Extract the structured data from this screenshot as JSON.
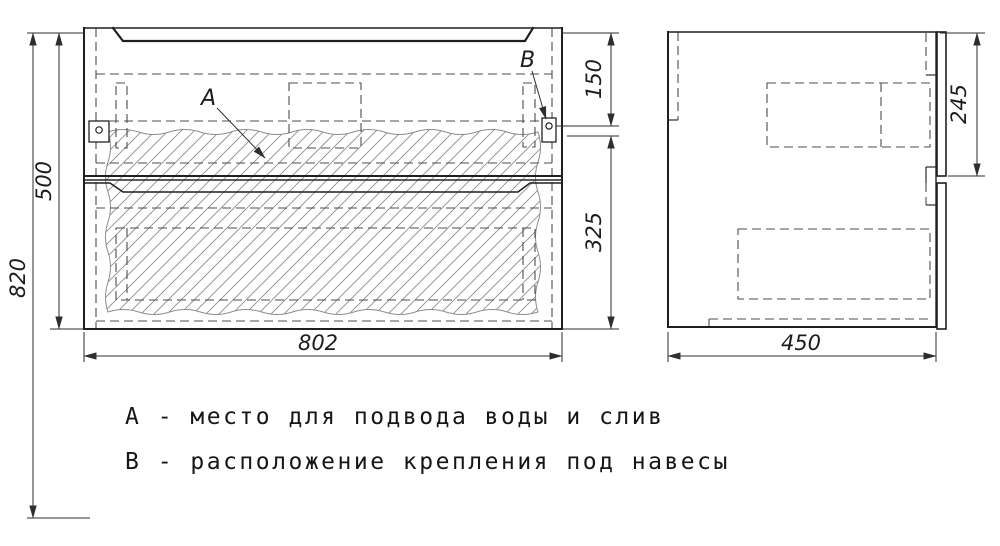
{
  "drawing": {
    "type": "furniture technical drawing, vanity cabinet, front and side views",
    "dimensions": {
      "overall_height": "820",
      "carcass_height": "500",
      "hanger_offset_top": "150",
      "hanger_offset_bottom": "325",
      "carcass_width": "802",
      "carcass_depth": "450",
      "drawer_front_height": "245"
    },
    "callouts": {
      "a": "А",
      "b": "В"
    },
    "legend": {
      "line_a": "А - место для подвода воды и слив",
      "line_b": "В - расположение крепления под навесы"
    },
    "colors": {
      "background": "#ffffff",
      "outline": "#1f1f1f",
      "hidden_line": "#4d4d4d",
      "hatch": "#8d8d8d",
      "dimension": "#2e2e2e"
    }
  }
}
